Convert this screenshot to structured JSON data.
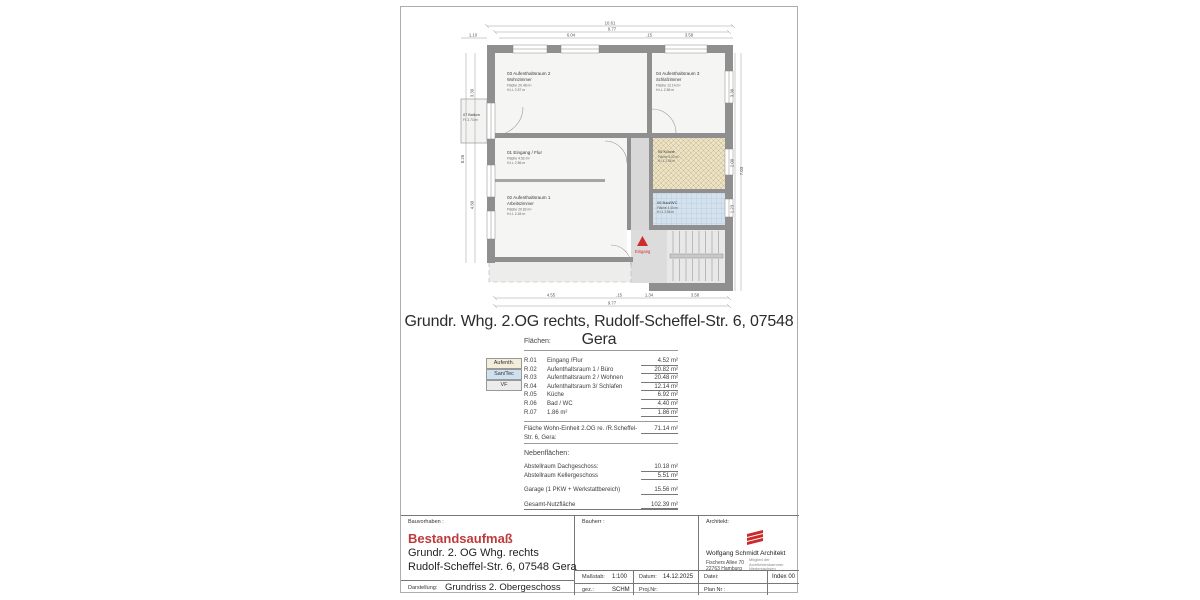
{
  "colors": {
    "accent_red": "#bf3b3b",
    "wall_gray": "#8f8f8f",
    "legend_aufenth_bg": "#f3edd9",
    "legend_santec_bg": "#cfe1ef",
    "legend_vf_bg": "#ececec"
  },
  "main_title": "Grundr. Whg. 2.OG rechts, Rudolf-Scheffel-Str. 6, 07548 Gera",
  "plan": {
    "rooms": {
      "r01": {
        "title": "01 Eingang / Flur",
        "area": "Fläche 4.52 m²",
        "hil": "H.i.L 2.56 m"
      },
      "r02": {
        "title": "02 Aufenthaltsraum 1",
        "sub": "Arbeitszimmer",
        "area": "Fläche 20.82 m²",
        "hil": "H.i.L 2.45 m"
      },
      "r03": {
        "title": "03 Aufenthaltsraum 2",
        "sub": "Wohnzimmer",
        "area": "Fläche 20.48 m²",
        "hil": "H.i.L 2.57 m"
      },
      "r04": {
        "title": "04 Aufenthaltsraum 3",
        "sub": "Schlafzimmer",
        "area": "Fläche 12.14 m²",
        "hil": "H.i.L 2.56 m"
      },
      "r05": {
        "title": "05 Küche",
        "area": "Fläche 6.92 m²",
        "hil": "H.i.L 2.56 m"
      },
      "r06": {
        "title": "06 Bad/WC",
        "area": "Fläche 4.40 m²",
        "hil": "H.i.L 2.56 m"
      },
      "r07": {
        "title": "07 Balkon",
        "area": "Fl. 3.73 m²"
      }
    },
    "entrance_label": "Eingang",
    "dims": {
      "top_total": "10.61",
      "top_inner": "9.77",
      "top_left": "6.04",
      "top_gap": ".15",
      "top_right": "3.58",
      "balcony_width": "1.10",
      "left_total": "8.26",
      "left_upper": "3.39",
      "left_lower": "4.60",
      "right_total": "7.03",
      "right_upper": "3.39",
      "right_mid": "2.00",
      "right_lower": "1.23",
      "bottom_room": "4.55",
      "bottom_gap": ".15",
      "bottom_hall": "1.34",
      "bottom_stair": "3.58",
      "bottom_inner": "9.77"
    }
  },
  "areas_table": {
    "heading": "Flächen:",
    "legend": [
      {
        "label": "Aufenth."
      },
      {
        "label": "San/Tec"
      },
      {
        "label": "VF"
      }
    ],
    "rows": [
      {
        "code": "R.01",
        "name": "Eingang /Flur",
        "value": "4.52 m²"
      },
      {
        "code": "R.02",
        "name": "Aufenthaltsraum 1 / Büro",
        "value": "20.82 m²"
      },
      {
        "code": "R.03",
        "name": "Aufenthaltsraum 2 / Wohnen",
        "value": "20.48 m²"
      },
      {
        "code": "R.04",
        "name": "Aufenthaltsraum 3/ Schlafen",
        "value": "12.14 m²"
      },
      {
        "code": "R.05",
        "name": "Küche",
        "value": "6.92 m²"
      },
      {
        "code": "R.06",
        "name": "Bad / WC",
        "value": "4.40 m²"
      },
      {
        "code": "R.07",
        "name": "Balkon ( 3.73 m²  * 50% )",
        "value": "1.86 m²"
      }
    ],
    "total_label": "Fläche Wohn-Einheit 2.OG re. /R.Scheffel-Str. 6, Gera:",
    "total_value": "71.14 m²"
  },
  "secondary_areas": {
    "heading": "Nebenflächen:",
    "rows": [
      {
        "label": "Abstellraum Dachgeschoss:",
        "value": "10.18 m²"
      },
      {
        "label": "Abstellraum Kellergeschoss",
        "value": "5.51 m²"
      }
    ],
    "garage_label": "Garage (1 PKW + Werkstattbereich)",
    "garage_value": "15.56 m²",
    "total_label": "Gesamt-Nutzfläche",
    "total_value": "102.39 m²"
  },
  "title_block": {
    "bauvorhaben_label": "Bauvorhaben :",
    "project_name": "Bestandsaufmaß",
    "project_line1": "Grundr. 2. OG Whg. rechts",
    "project_line2": "Rudolf-Scheffel-Str. 6, 07548 Gera",
    "darstellung_label": "Darstellung:",
    "darstellung_value": "Grundriss 2. Obergeschoss",
    "bauherr_label": "Bauherr :",
    "architekt_label": "Architekt:",
    "architect_name": "Wolfgang Schmidt  Architekt",
    "architect_addr1": "Fischers Allee 70",
    "architect_addr2": "22763 Hamburg",
    "architect_member1": "Mitglied der",
    "architect_member2": "Architektenkammer",
    "architect_member3": "Niedersachsen",
    "massstab_label": "Maßstab:",
    "massstab_value": "1:100",
    "datum_label": "Datum:",
    "datum_value": "14.12.2025",
    "datei_label": "Datei:",
    "index_value": "Index 00",
    "gez_label": "gez.:",
    "gez_value": "SCHM",
    "projnr_label": "Proj.Nr:",
    "plannr_label": "Plan Nr :"
  }
}
